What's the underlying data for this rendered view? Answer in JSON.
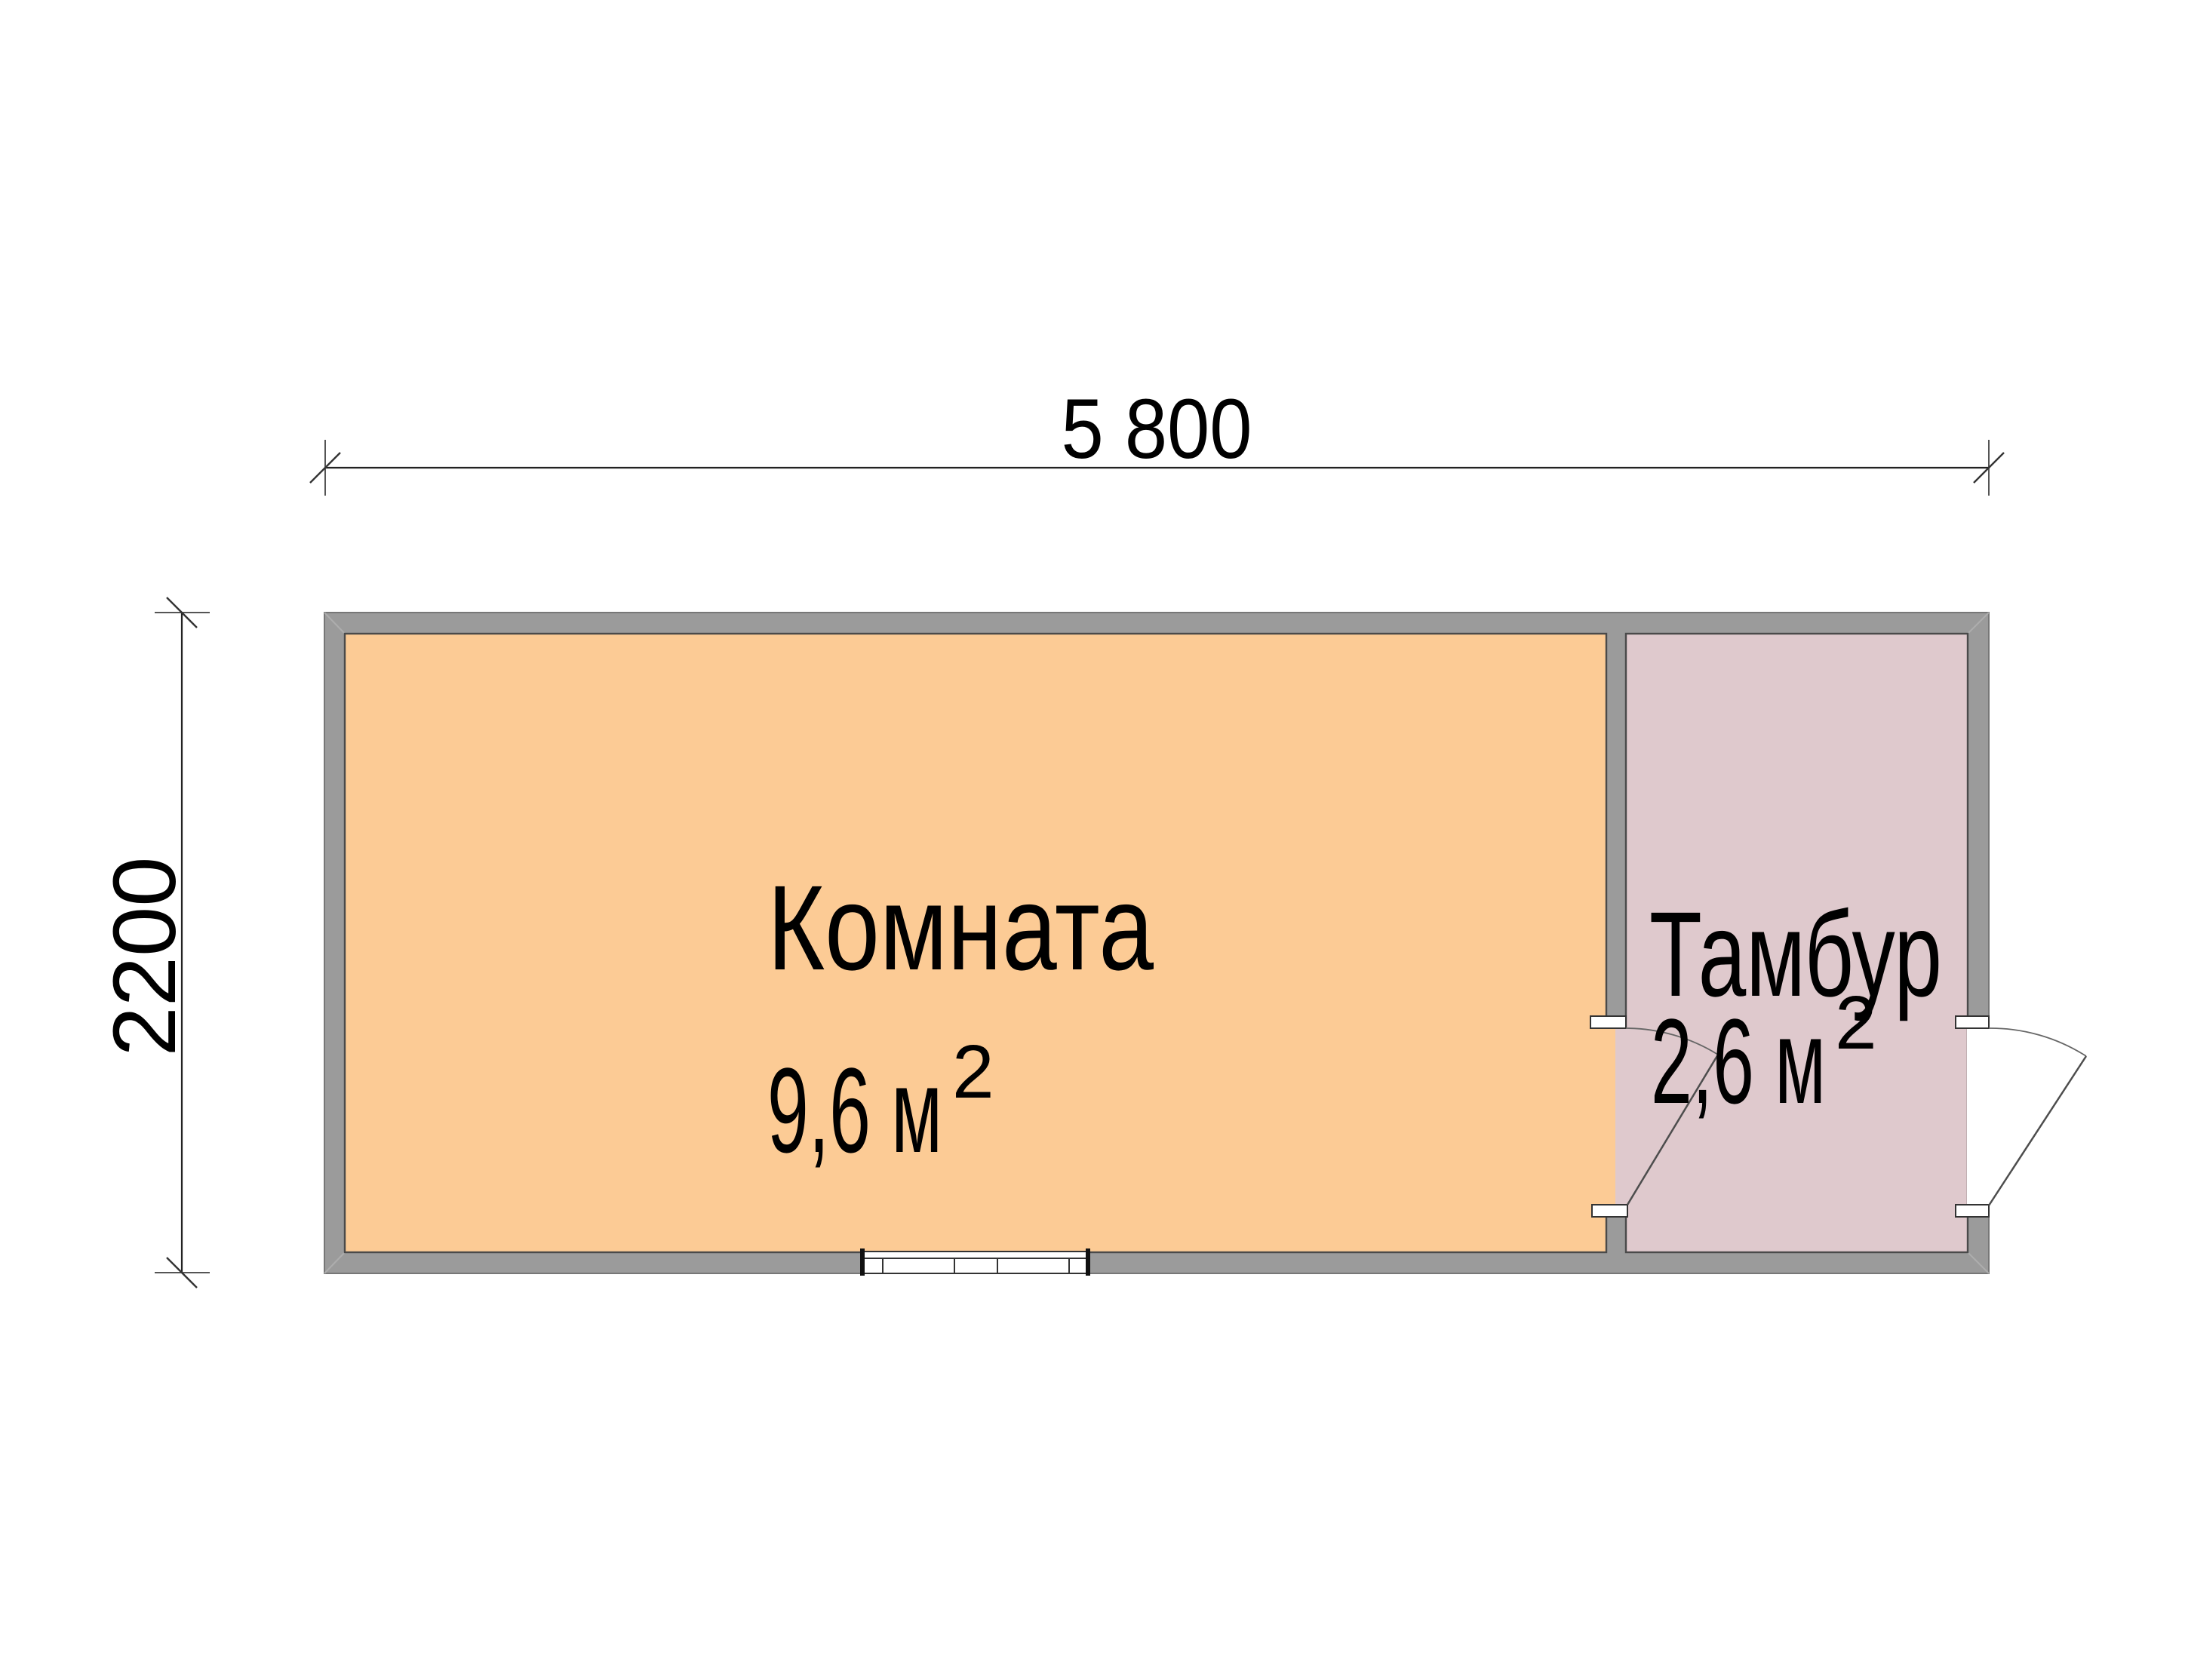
{
  "floor_plan": {
    "dimensions": {
      "overall_width_label": "5 800",
      "overall_depth_label": "2200"
    },
    "rooms": [
      {
        "name": "Комната",
        "area_value": "9,6 м",
        "area_superscript": "2"
      },
      {
        "name": "Тамбур",
        "area_value": "2,6 м",
        "area_superscript": "2"
      }
    ],
    "colors": {
      "wall_fill": "#9b9b9b",
      "wall_edge": "#4a4a4a",
      "room_fill": "#fccb95",
      "vestibule_fill": "#dfc9cd",
      "dimension_line": "#222222",
      "door_line": "#4d4d4d"
    }
  }
}
